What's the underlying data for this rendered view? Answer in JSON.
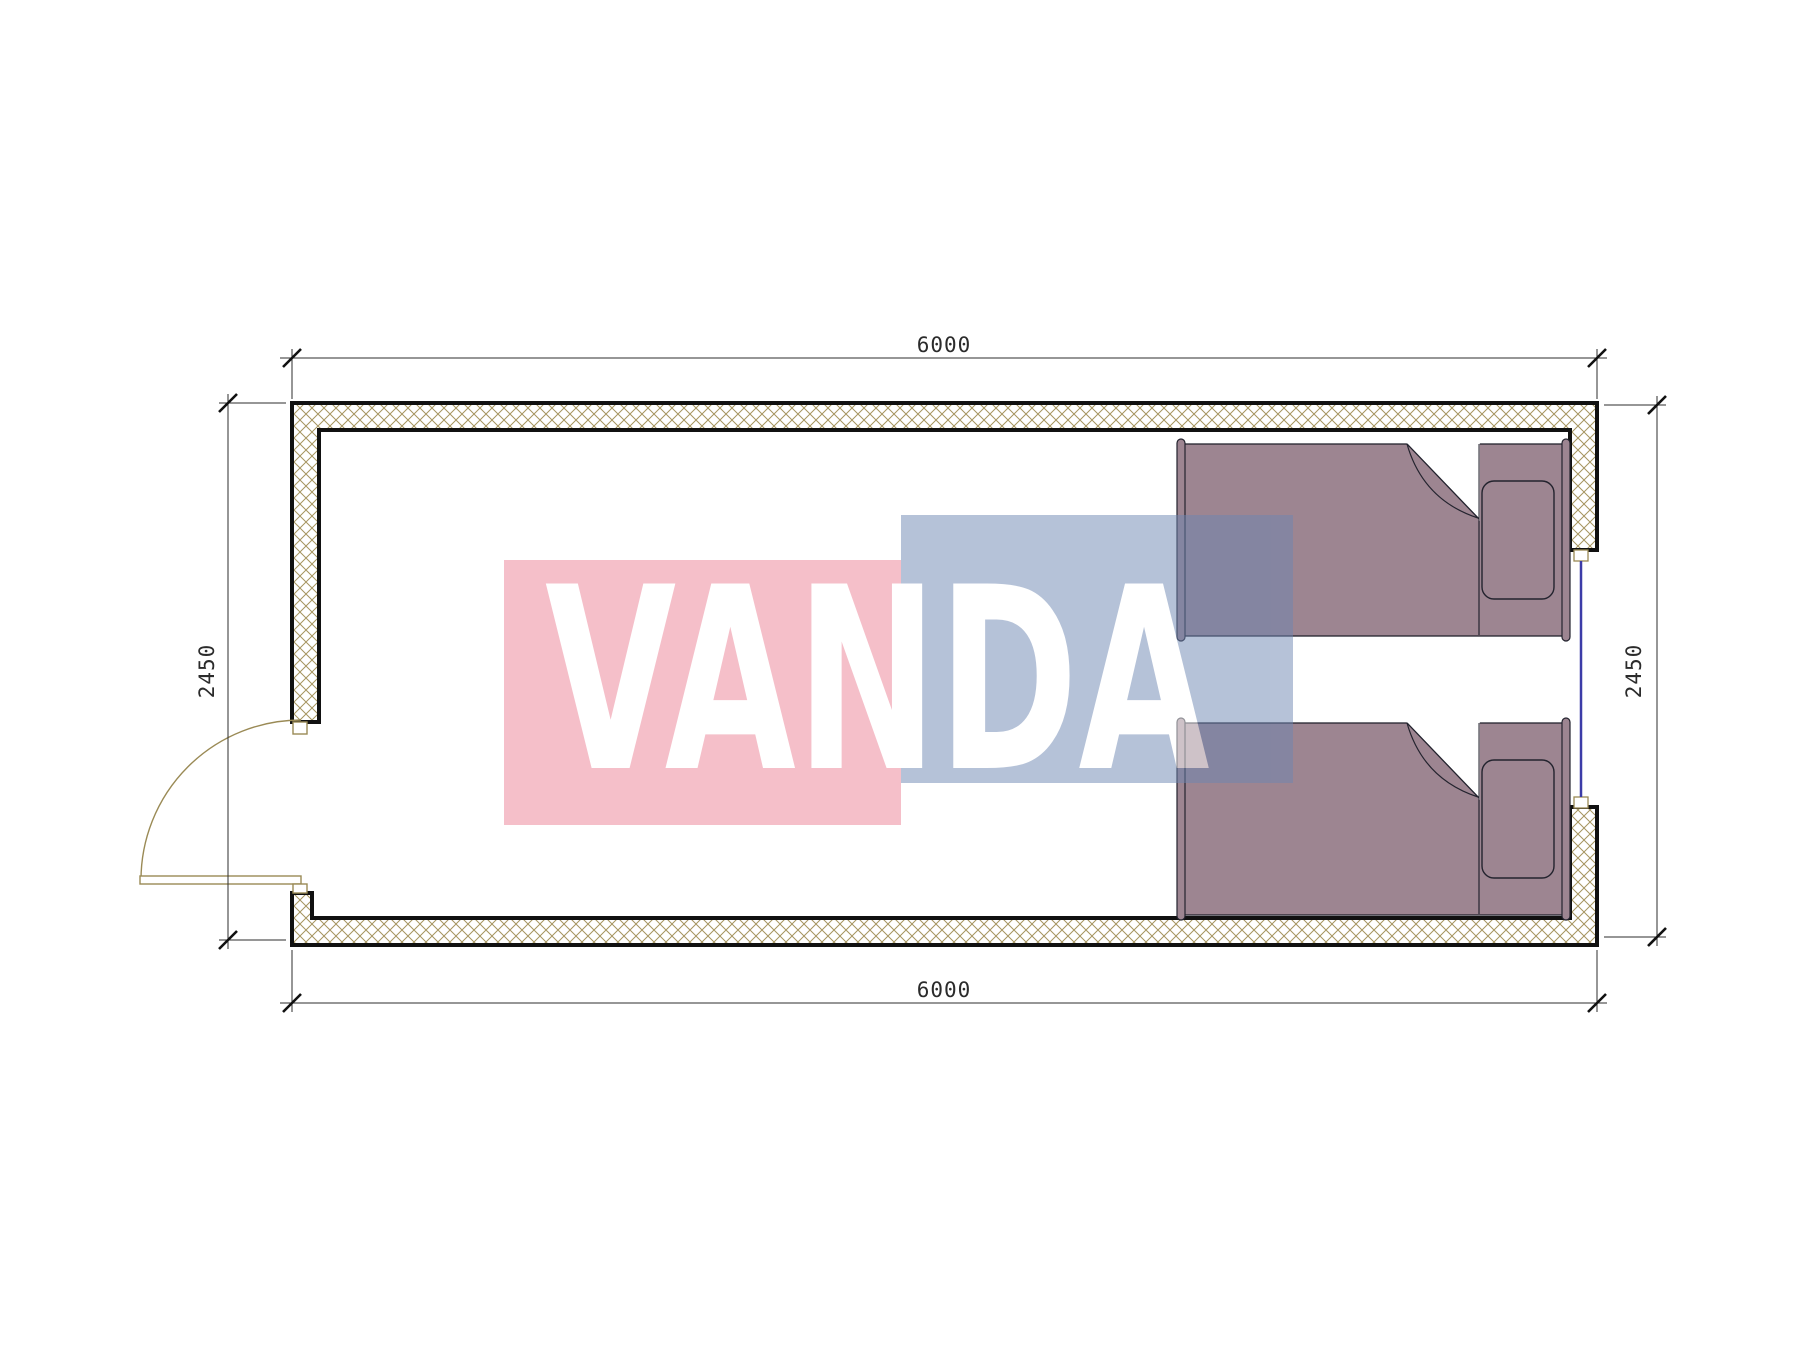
{
  "drawing": {
    "type": "floor-plan",
    "subject": "modular-container-bedroom-plan",
    "watermark": {
      "text": "VANDA",
      "pink_color": "#EC8095",
      "blue_color": "#6D86B2",
      "text_color": "#FFFFFF"
    },
    "dimensions": {
      "top": {
        "label": "6000"
      },
      "bottom": {
        "label": "6000"
      },
      "left": {
        "label": "2450"
      },
      "right": {
        "label": "2450"
      }
    },
    "colors": {
      "bed_fill": "#9D8591",
      "bed_outline": "#23232E",
      "wall_hatch": "#A6955F",
      "wall_outline": "#111111",
      "window_glass": "#3C3CA8",
      "door": "#9A8A55",
      "dimension_line": "#2E2E2E",
      "dimension_text": "#2B2B2B"
    }
  }
}
